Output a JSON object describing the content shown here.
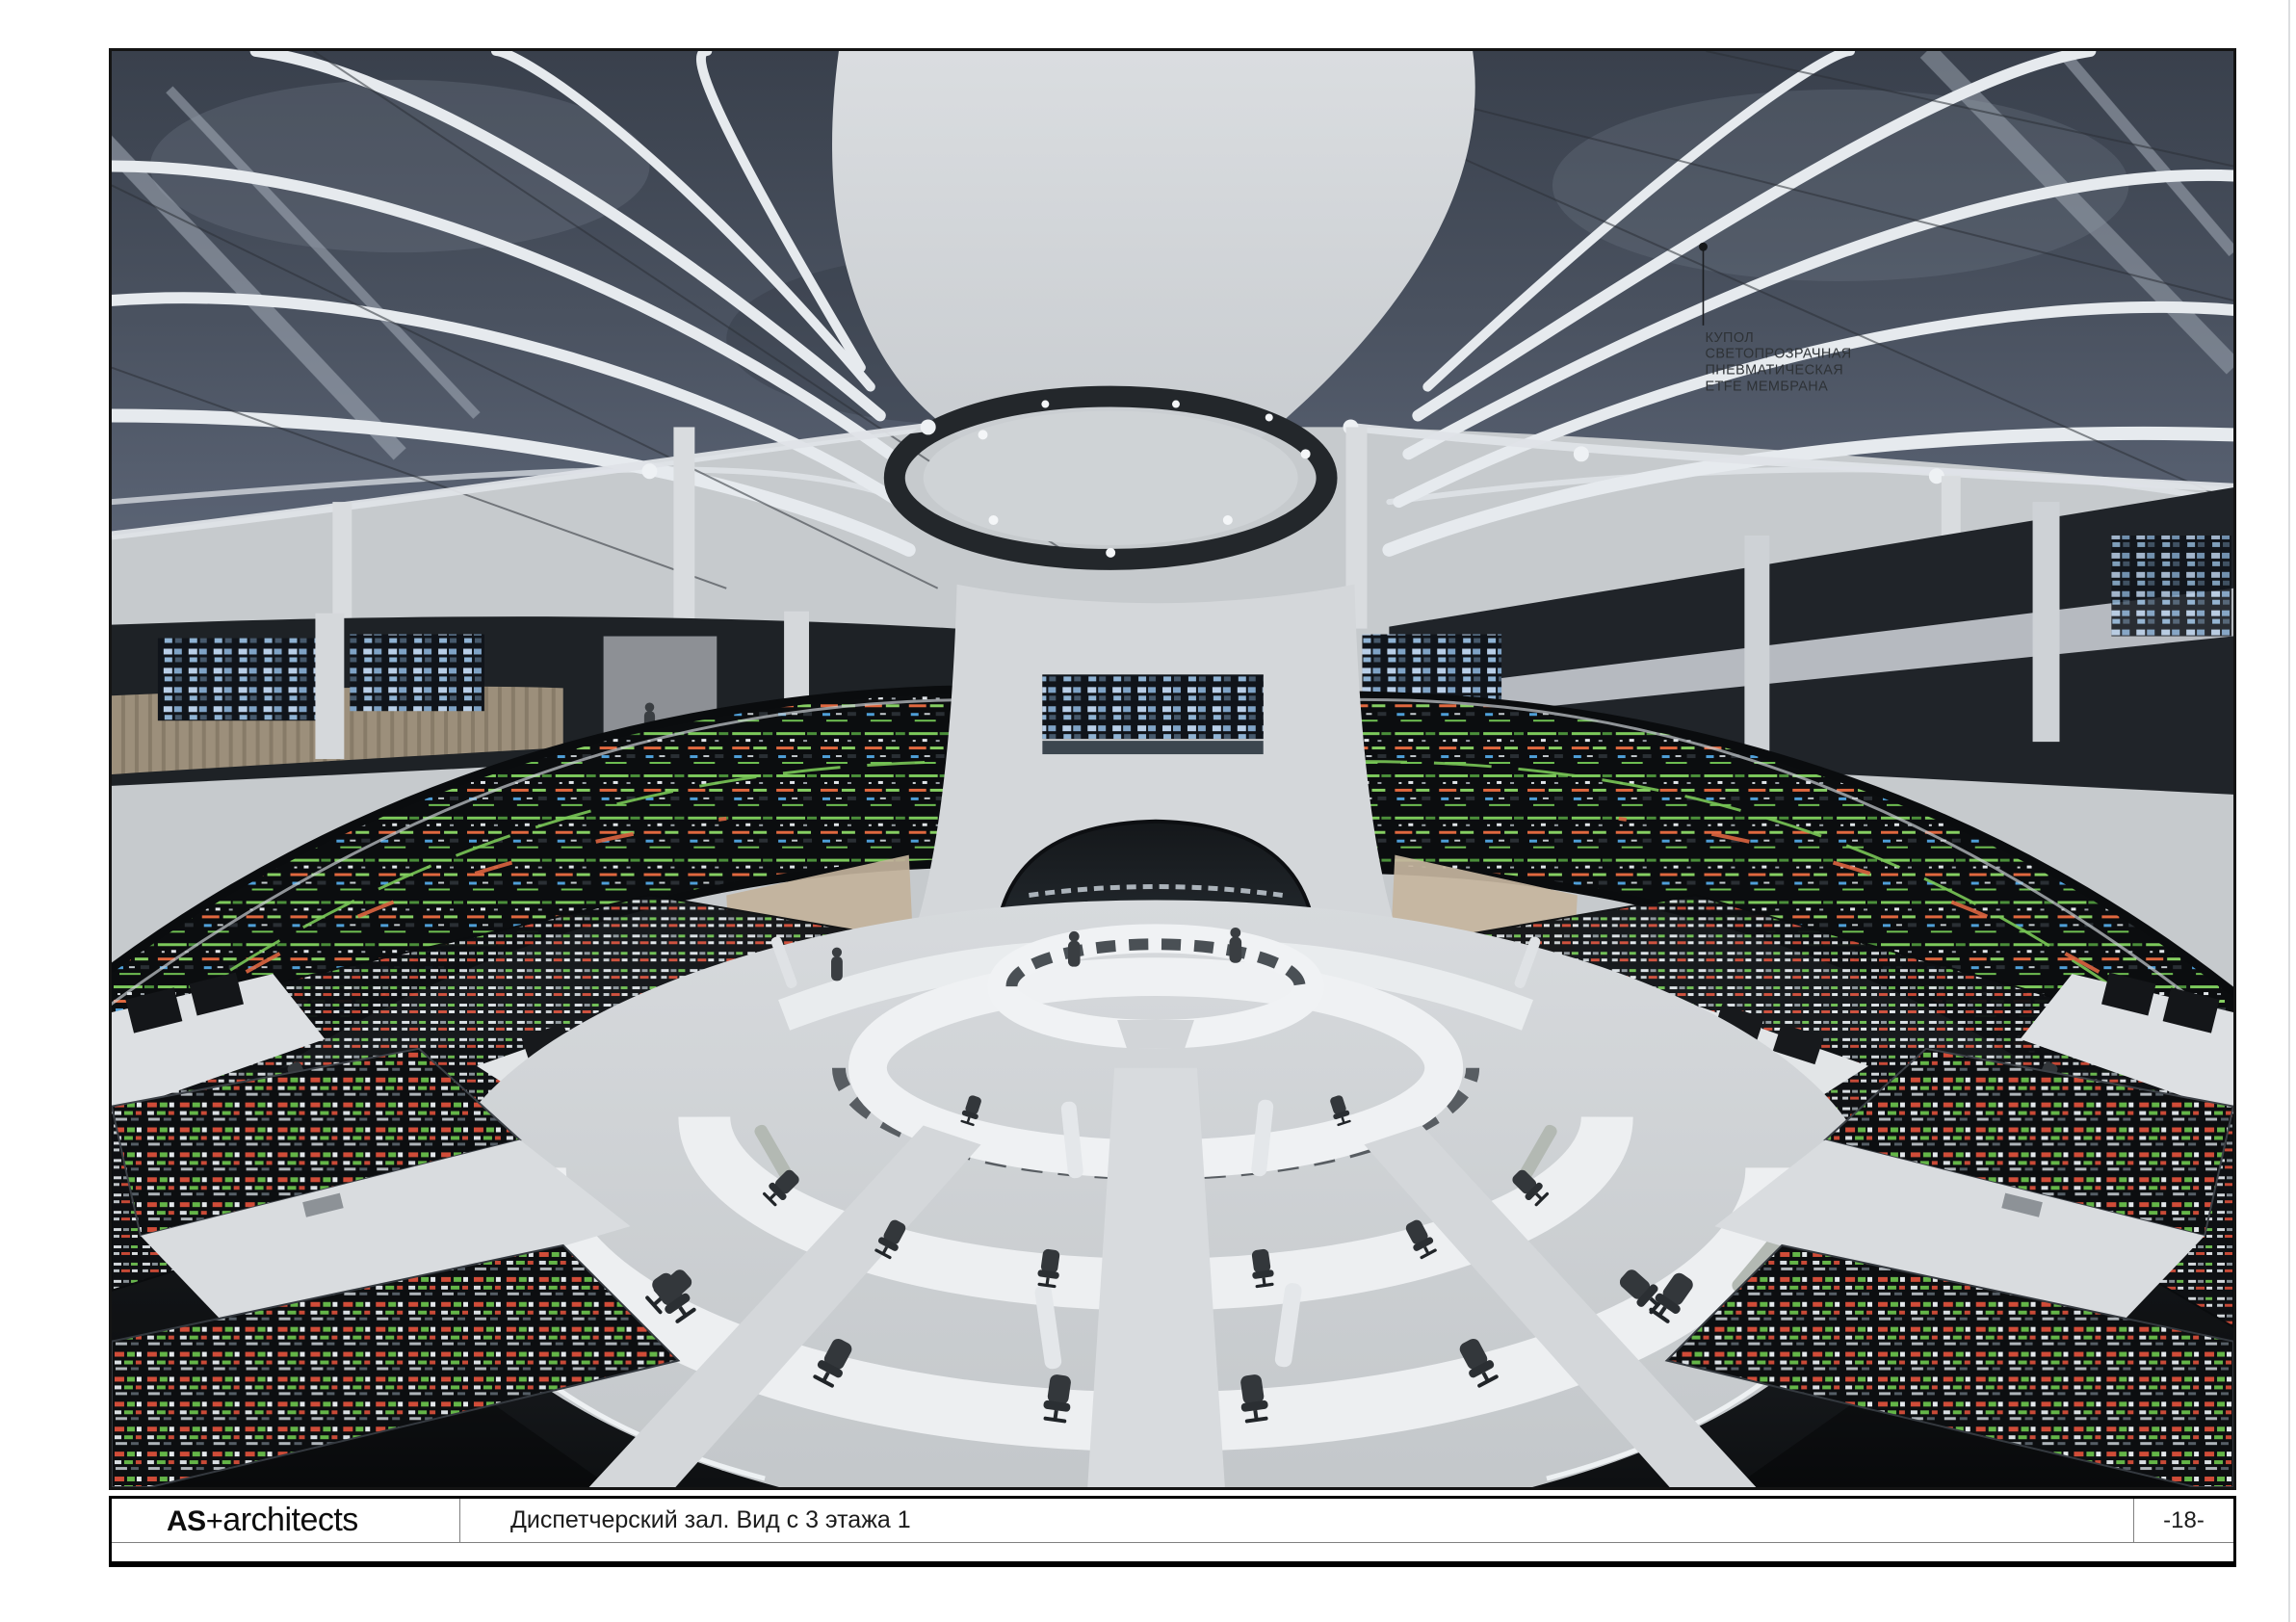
{
  "annotation": {
    "lines": [
      "КУПОЛ",
      "СВЕТОПРОЗРАЧНАЯ",
      "ПНЕВМАТИЧЕСКАЯ",
      "ETFE МЕМБРАНА"
    ]
  },
  "title_block": {
    "logo_primary": "AS",
    "logo_plus": "+",
    "logo_secondary": "architects",
    "caption": "Диспетчерский зал. Вид с 3 этажа 1",
    "page_number": "-18-"
  },
  "palette": {
    "glazing_dark": "#46505e",
    "structure_white": "#e8ecef",
    "drum_gray": "#d2d5d8",
    "screen_green": "#7cc95b",
    "screen_red": "#d0543c",
    "screen_blue": "#4f9fd8",
    "desk_white": "#edeff1",
    "floor_dark": "#14171a"
  }
}
